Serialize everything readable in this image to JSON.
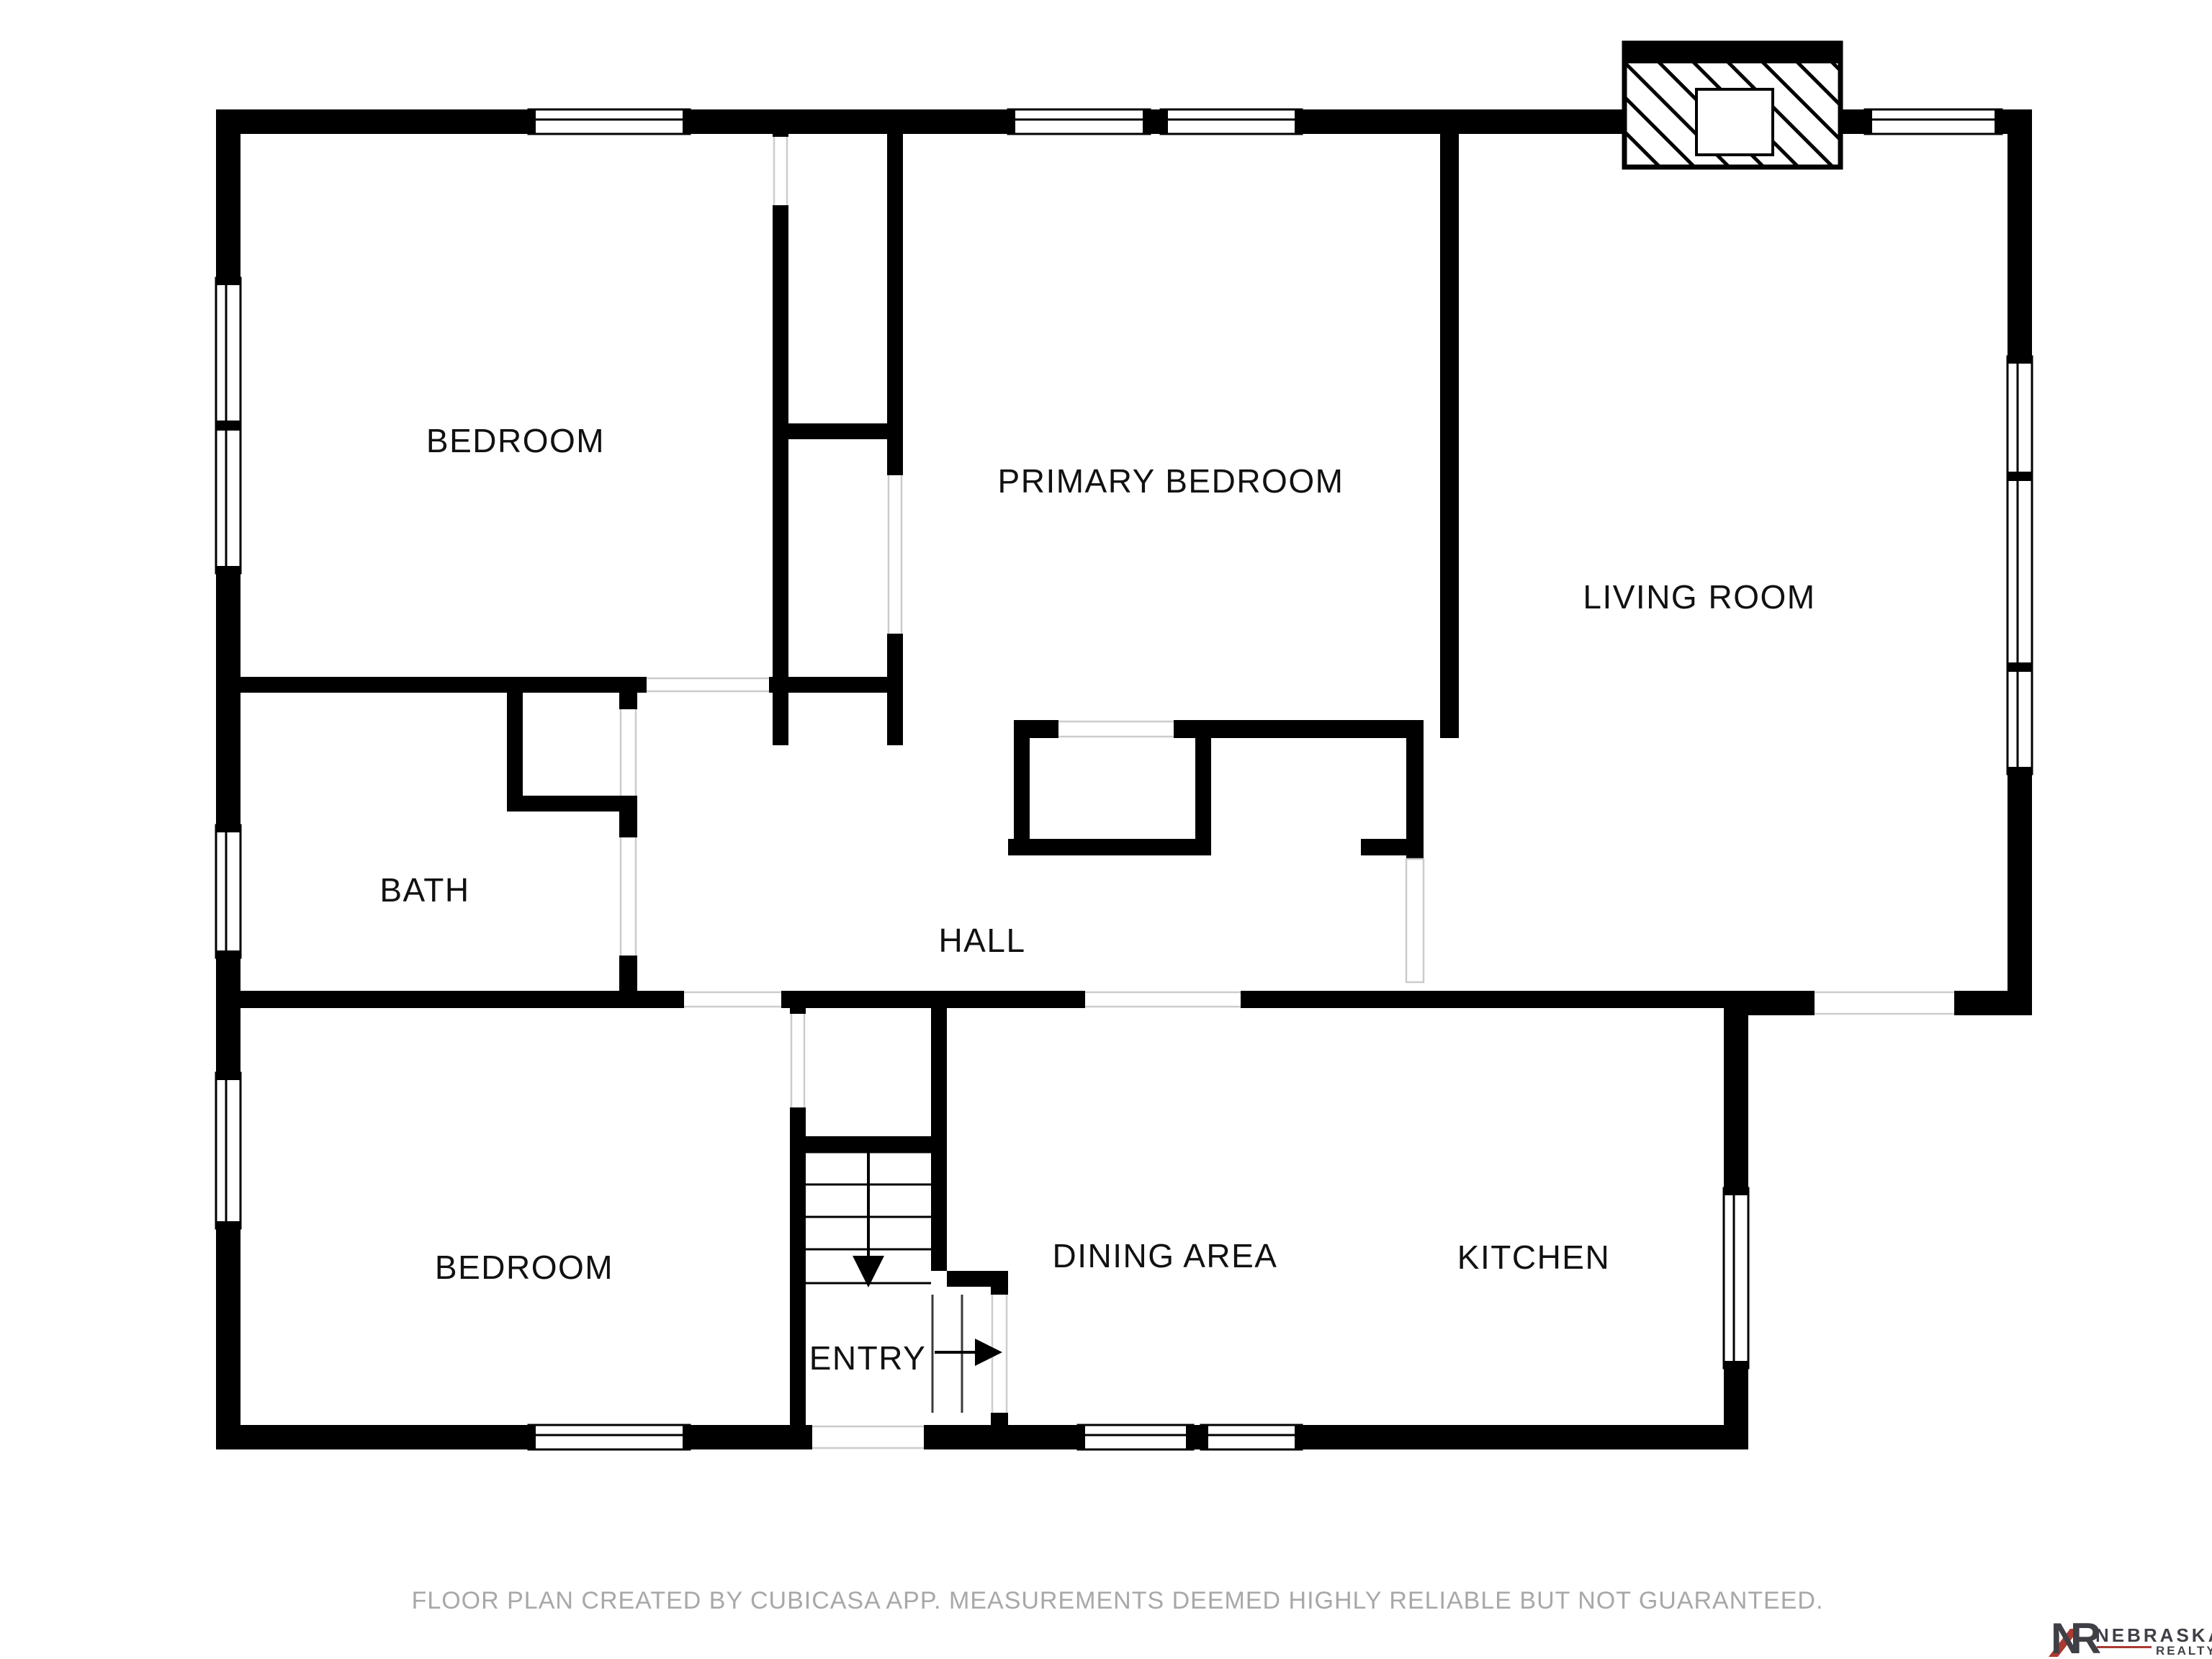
{
  "floor_plan": {
    "rooms": [
      {
        "id": "bedroom-top-left",
        "label": "BEDROOM"
      },
      {
        "id": "primary-bedroom",
        "label": "PRIMARY BEDROOM"
      },
      {
        "id": "living-room",
        "label": "LIVING ROOM"
      },
      {
        "id": "bath",
        "label": "BATH"
      },
      {
        "id": "hall",
        "label": "HALL"
      },
      {
        "id": "bedroom-bottom-left",
        "label": "BEDROOM"
      },
      {
        "id": "entry",
        "label": "ENTRY"
      },
      {
        "id": "dining-area",
        "label": "DINING AREA"
      },
      {
        "id": "kitchen",
        "label": "KITCHEN"
      }
    ],
    "icons": [
      {
        "name": "stairs-down-arrow"
      },
      {
        "name": "entry-direction-arrow"
      },
      {
        "name": "fireplace-hatch"
      }
    ],
    "colors": {
      "wall": "#000000",
      "opening_line": "#cccccc",
      "label_text": "#111111"
    }
  },
  "footer": {
    "disclaimer": "FLOOR PLAN CREATED BY CUBICASA APP. MEASUREMENTS DEEMED HIGHLY RELIABLE BUT NOT GUARANTEED."
  },
  "logo": {
    "monogram_n": "N",
    "monogram_r": "R",
    "name": "NEBRASKA",
    "subtitle": "REALTY",
    "text_color": "#3F3F46",
    "accent_color": "#A93B32"
  }
}
